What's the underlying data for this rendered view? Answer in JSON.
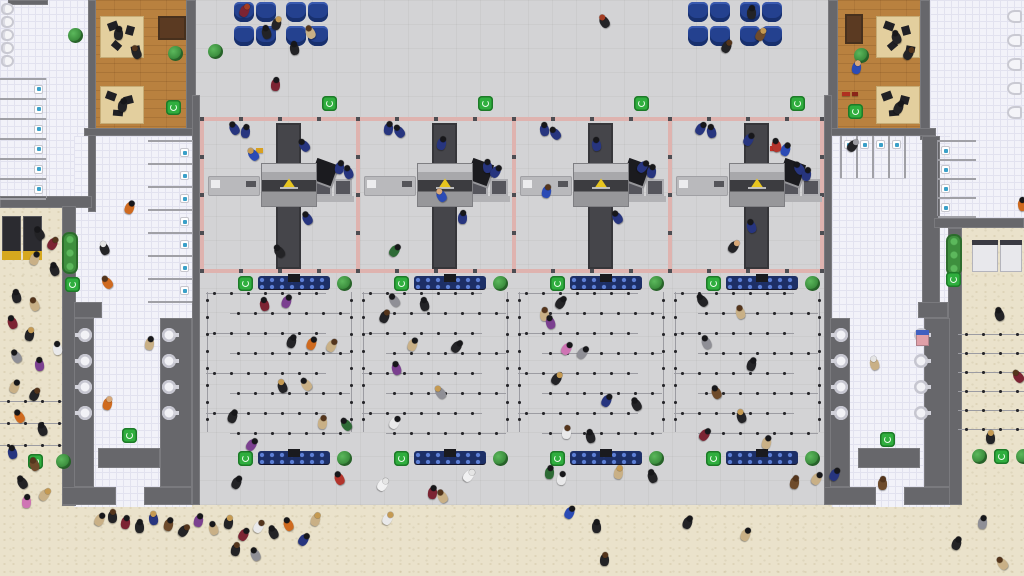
{
  "meta": {
    "app": "airport-simulation-game",
    "view": "overhead view of terminal security checkpoint zone, queues, restrooms, offices and landside entrances"
  },
  "palette": {
    "floor_gray": "#d3d3d5",
    "sand": "#eae2cb",
    "wall": "#67676b",
    "tile": "#f2f2f9",
    "wood": "#b9813f",
    "seat_blue": "#24418f",
    "security_border_pink": "#dfb3af",
    "bin_green": "#2fae3e",
    "plant_green": "#3e8f3e",
    "conveyor_dark": "#45454a",
    "machine_gray": "#a8a8ab",
    "xray_yellow": "#e8c51e",
    "bench_navy": "#1d2f66",
    "desk_tan": "#e3cf9e",
    "officer_navy": "#27357f"
  },
  "regions": [
    {
      "kind": "floor",
      "name": "terminal-hall-floor",
      "x": 192,
      "y": 0,
      "w": 640,
      "h": 505
    },
    {
      "kind": "tile",
      "name": "restroom-top-left-floor",
      "x": 0,
      "y": 0,
      "w": 92,
      "h": 204
    },
    {
      "kind": "wood",
      "name": "office-top-left-floor",
      "x": 88,
      "y": 0,
      "w": 108,
      "h": 132
    },
    {
      "kind": "tile",
      "name": "corridor-left-floor",
      "x": 74,
      "y": 136,
      "w": 118,
      "h": 371
    },
    {
      "kind": "tile",
      "name": "restroom-top-right-floor",
      "x": 930,
      "y": 0,
      "w": 94,
      "h": 222
    },
    {
      "kind": "wood",
      "name": "office-top-right-floor",
      "x": 828,
      "y": 0,
      "w": 102,
      "h": 132
    },
    {
      "kind": "tile",
      "name": "corridor-right-floor",
      "x": 832,
      "y": 136,
      "w": 118,
      "h": 371
    }
  ],
  "walls": [
    [
      8,
      0,
      40,
      5
    ],
    [
      88,
      0,
      8,
      212
    ],
    [
      186,
      0,
      10,
      132
    ],
    [
      84,
      128,
      112,
      8
    ],
    [
      0,
      196,
      92,
      12
    ],
    [
      62,
      206,
      14,
      300
    ],
    [
      74,
      302,
      28,
      16
    ],
    [
      192,
      95,
      8,
      410
    ],
    [
      74,
      318,
      20,
      169
    ],
    [
      160,
      318,
      32,
      169
    ],
    [
      98,
      448,
      62,
      20
    ],
    [
      62,
      487,
      54,
      18
    ],
    [
      144,
      487,
      48,
      18
    ],
    [
      920,
      0,
      10,
      140
    ],
    [
      828,
      0,
      10,
      132
    ],
    [
      824,
      128,
      112,
      8
    ],
    [
      922,
      136,
      18,
      182
    ],
    [
      934,
      218,
      90,
      10
    ],
    [
      948,
      228,
      14,
      277
    ],
    [
      918,
      302,
      30,
      16
    ],
    [
      824,
      95,
      8,
      410
    ],
    [
      830,
      318,
      20,
      169
    ],
    [
      924,
      318,
      26,
      169
    ],
    [
      858,
      448,
      62,
      20
    ],
    [
      824,
      487,
      52,
      18
    ],
    [
      904,
      487,
      46,
      18
    ]
  ],
  "security_border": {
    "v_xs": [
      200,
      356,
      512,
      668,
      820
    ],
    "y": 117,
    "h": 156,
    "h_spans": [
      [
        200,
        117,
        624
      ],
      [
        200,
        269,
        624
      ]
    ],
    "stud_ys": [
      117,
      155,
      193,
      231,
      269
    ],
    "stud_step_x": 39
  },
  "checkpoints": {
    "room_xs": [
      200,
      356,
      512,
      668
    ],
    "y": 117,
    "room_w": 156,
    "conveyor": {
      "dx": 76,
      "dy": 6,
      "w": 25,
      "h": 146
    },
    "machine": {
      "dx": 62,
      "dy": 47,
      "w": 54,
      "h": 42
    },
    "desk": {
      "dx": 8,
      "dy": 59,
      "w": 52,
      "h": 20
    },
    "monitor": {
      "dx": 113,
      "dy": 44,
      "w": 22,
      "h": 22
    },
    "trays": {
      "dx": 114,
      "dy": 62,
      "w": 18,
      "h": 17,
      "gap": 20
    },
    "shelf": {
      "dx": 110,
      "dy": 79,
      "w": 44,
      "h": 6
    }
  },
  "queue": {
    "block_xs": [
      204,
      360,
      516,
      672
    ],
    "top_y": 276,
    "bottom_y": 451,
    "bin_dx": 34,
    "bench_dx": 54,
    "bench_w": 72,
    "bench_h": 13,
    "plant_dx": 133,
    "lines_y0": 292,
    "lines_dy": 20,
    "lines_n": 8,
    "line_len": 120,
    "inset_even": 2,
    "inset_odd": 26,
    "v_edge_dx": [
      2,
      146
    ]
  },
  "sand_lines": {
    "left": {
      "x": 0,
      "w": 62,
      "ys": [
        400,
        422,
        444
      ]
    },
    "right": {
      "x": 958,
      "w": 66,
      "ys": [
        333,
        352,
        371,
        390,
        409,
        428
      ]
    }
  },
  "seats": {
    "size": 20,
    "groups": [
      {
        "x": 234,
        "y": 2,
        "cols": [
          0,
          22,
          52,
          74
        ],
        "rows": [
          0,
          24
        ]
      },
      {
        "x": 688,
        "y": 2,
        "cols": [
          0,
          22,
          52,
          74
        ],
        "rows": [
          0,
          24
        ]
      }
    ]
  },
  "urinals": {
    "x": 1,
    "y0": 3,
    "dy": 13,
    "n": 5
  },
  "toilets_wall": {
    "x": 1007,
    "y0": 10,
    "dy": 24,
    "n": 5
  },
  "stalls": [
    {
      "x": 0,
      "y0": 78,
      "w": 46,
      "dy": 20,
      "n": 6,
      "toilet": "right"
    },
    {
      "x": 148,
      "y0": 140,
      "w": 44,
      "dy": 23,
      "n": 7,
      "toilet": "right"
    },
    {
      "x": 938,
      "y0": 140,
      "w": 38,
      "dy": 19,
      "n": 4,
      "toilet": "left"
    }
  ],
  "stalls_v": {
    "x0": 840,
    "dx": 16,
    "n": 4,
    "y": 136,
    "h": 42
  },
  "fountains": [
    {
      "x": 78,
      "y0": 328,
      "dy": 26,
      "n": 4,
      "side": "fl"
    },
    {
      "x": 162,
      "y0": 328,
      "dy": 26,
      "n": 4,
      "side": "fr"
    },
    {
      "x": 834,
      "y0": 328,
      "dy": 26,
      "n": 4,
      "side": "fl"
    },
    {
      "x": 914,
      "y0": 328,
      "dy": 26,
      "n": 4,
      "side": "fr"
    }
  ],
  "vending": [
    {
      "x": 2,
      "y": 216,
      "w": 19,
      "h": 44,
      "s": "dark"
    },
    {
      "x": 23,
      "y": 216,
      "w": 19,
      "h": 44,
      "s": "dark"
    },
    {
      "x": 972,
      "y": 240,
      "w": 26,
      "h": 32,
      "s": "light"
    },
    {
      "x": 1000,
      "y": 240,
      "w": 22,
      "h": 32,
      "s": "light"
    },
    {
      "x": 916,
      "y": 330,
      "w": 13,
      "h": 16,
      "s": "pink"
    }
  ],
  "planters": [
    [
      62,
      232,
      16,
      42
    ],
    [
      946,
      234,
      16,
      42
    ]
  ],
  "plants": [
    [
      168,
      46
    ],
    [
      854,
      48
    ],
    [
      68,
      28
    ],
    [
      208,
      44
    ],
    [
      56,
      454
    ],
    [
      972,
      449
    ],
    [
      1016,
      449
    ]
  ],
  "bins": [
    [
      322,
      96
    ],
    [
      478,
      96
    ],
    [
      634,
      96
    ],
    [
      790,
      96
    ],
    [
      166,
      100
    ],
    [
      848,
      104
    ],
    [
      122,
      428
    ],
    [
      880,
      432
    ],
    [
      28,
      454
    ],
    [
      65,
      277
    ],
    [
      946,
      272
    ],
    [
      994,
      449
    ]
  ],
  "office_benches": [
    [
      158,
      16,
      28,
      24
    ],
    [
      845,
      14,
      18,
      30
    ]
  ],
  "office_desks": [
    [
      100,
      16,
      44,
      42
    ],
    [
      100,
      86,
      44,
      38
    ],
    [
      876,
      16,
      44,
      42
    ],
    [
      876,
      86,
      44,
      38
    ]
  ],
  "office_items": [
    [
      108,
      22,
      10,
      8,
      -20
    ],
    [
      126,
      26,
      8,
      9,
      15
    ],
    [
      112,
      42,
      9,
      7,
      40
    ],
    [
      131,
      46,
      9,
      6,
      -10
    ],
    [
      106,
      92,
      10,
      8,
      20
    ],
    [
      124,
      96,
      9,
      8,
      -15
    ],
    [
      113,
      110,
      10,
      6,
      5
    ],
    [
      884,
      22,
      10,
      8,
      20
    ],
    [
      902,
      26,
      8,
      9,
      -15
    ],
    [
      888,
      42,
      9,
      7,
      -40
    ],
    [
      906,
      46,
      9,
      6,
      10
    ],
    [
      882,
      92,
      10,
      8,
      -20
    ],
    [
      900,
      96,
      9,
      8,
      15
    ],
    [
      889,
      110,
      10,
      6,
      -5
    ]
  ],
  "props": [
    [
      256,
      148,
      "#d8a020",
      7,
      5
    ],
    [
      770,
      146,
      "#c03028",
      7,
      5
    ],
    [
      842,
      92,
      "#b03020",
      8,
      4
    ],
    [
      852,
      92,
      "#8a2418",
      6,
      4
    ]
  ],
  "officers": [
    [
      230,
      123
    ],
    [
      241,
      126
    ],
    [
      300,
      140
    ],
    [
      335,
      162
    ],
    [
      344,
      167
    ],
    [
      303,
      213
    ],
    [
      384,
      123
    ],
    [
      395,
      126
    ],
    [
      437,
      138
    ],
    [
      483,
      161
    ],
    [
      491,
      166
    ],
    [
      458,
      212
    ],
    [
      540,
      124
    ],
    [
      551,
      128
    ],
    [
      592,
      139
    ],
    [
      638,
      161
    ],
    [
      647,
      166
    ],
    [
      613,
      212
    ],
    [
      696,
      123
    ],
    [
      707,
      126
    ],
    [
      744,
      134
    ],
    [
      795,
      163
    ],
    [
      802,
      169
    ],
    [
      747,
      221
    ]
  ],
  "people": [
    [
      240,
      5,
      "#7c2433",
      "#a33c22"
    ],
    [
      262,
      27,
      "#232326",
      "#17171a"
    ],
    [
      306,
      27,
      "#c9b086",
      "#54351c"
    ],
    [
      272,
      18,
      "#232326",
      "#c59a52"
    ],
    [
      290,
      43,
      "#232326",
      "#17171a"
    ],
    [
      271,
      79,
      "#7c2433",
      "#17171a"
    ],
    [
      600,
      16,
      "#232326",
      "#a33c22"
    ],
    [
      747,
      7,
      "#232326",
      "#17171a"
    ],
    [
      756,
      29,
      "#6e4b2b",
      "#c59a52"
    ],
    [
      722,
      41,
      "#232326",
      "#54351c"
    ],
    [
      114,
      28,
      "#232326",
      "#17171a"
    ],
    [
      132,
      47,
      "#232326",
      "#54351c"
    ],
    [
      118,
      100,
      "#232326",
      "#17171a"
    ],
    [
      892,
      32,
      "#232326",
      "#17171a"
    ],
    [
      904,
      48,
      "#232326",
      "#54351c"
    ],
    [
      852,
      62,
      "#2b4bb5",
      "#d8a878"
    ],
    [
      894,
      102,
      "#232326",
      "#17171a"
    ],
    [
      125,
      202,
      "#cf6a1f",
      "#17171a"
    ],
    [
      100,
      243,
      "#232326",
      "#e5e5e5"
    ],
    [
      103,
      277,
      "#cf6a1f",
      "#54351c"
    ],
    [
      145,
      338,
      "#c9b086",
      "#17171a"
    ],
    [
      103,
      398,
      "#cf6a1f",
      "#d8a878"
    ],
    [
      848,
      140,
      "#232326",
      "#9a9aa0"
    ],
    [
      870,
      358,
      "#c9b086",
      "#e5e5e5"
    ],
    [
      878,
      478,
      "#6e4b2b",
      "#54351c"
    ],
    [
      249,
      149,
      "#2b4bb5",
      "#c59a52"
    ],
    [
      275,
      246,
      "#232326",
      "#17171a"
    ],
    [
      390,
      245,
      "#2e6b36",
      "#17171a"
    ],
    [
      437,
      190,
      "#2b4bb5",
      "#d8a878"
    ],
    [
      542,
      186,
      "#2b4bb5",
      "#54351c"
    ],
    [
      772,
      140,
      "#b3342c",
      "#17171a"
    ],
    [
      781,
      144,
      "#2b4bb5",
      "#17171a"
    ],
    [
      729,
      241,
      "#232326",
      "#d8a878"
    ],
    [
      282,
      296,
      "#7b4090",
      "#17171a"
    ],
    [
      260,
      299,
      "#7c2433",
      "#17171a"
    ],
    [
      287,
      336,
      "#232326",
      "#17171a"
    ],
    [
      307,
      338,
      "#cf6a1f",
      "#17171a"
    ],
    [
      327,
      340,
      "#c9b086",
      "#54351c"
    ],
    [
      302,
      379,
      "#c9b086",
      "#17171a"
    ],
    [
      278,
      381,
      "#232326",
      "#c59a52"
    ],
    [
      228,
      411,
      "#232326",
      "#17171a"
    ],
    [
      318,
      417,
      "#c9b086",
      "#54351c"
    ],
    [
      342,
      419,
      "#2e6b36",
      "#17171a"
    ],
    [
      247,
      439,
      "#7b4090",
      "#17171a"
    ],
    [
      390,
      295,
      "#8f8f96",
      "#17171a"
    ],
    [
      420,
      299,
      "#232326",
      "#17171a"
    ],
    [
      380,
      311,
      "#232326",
      "#54351c"
    ],
    [
      408,
      339,
      "#c9b086",
      "#17171a"
    ],
    [
      452,
      341,
      "#232326",
      "#17171a"
    ],
    [
      392,
      363,
      "#7b4090",
      "#17171a"
    ],
    [
      436,
      387,
      "#8f8f96",
      "#c59a52"
    ],
    [
      390,
      417,
      "#e9e9ea",
      "#17171a"
    ],
    [
      556,
      297,
      "#232326",
      "#17171a"
    ],
    [
      540,
      309,
      "#c9b086",
      "#54351c"
    ],
    [
      546,
      317,
      "#7b4090",
      "#17171a"
    ],
    [
      562,
      343,
      "#cf74b4",
      "#17171a"
    ],
    [
      578,
      347,
      "#8f8f96",
      "#17171a"
    ],
    [
      552,
      373,
      "#232326",
      "#c59a52"
    ],
    [
      602,
      395,
      "#27357f",
      "#17171a"
    ],
    [
      632,
      399,
      "#232326",
      "#17171a"
    ],
    [
      562,
      427,
      "#e9e9ea",
      "#54351c"
    ],
    [
      586,
      431,
      "#232326",
      "#17171a"
    ],
    [
      698,
      295,
      "#232326",
      "#17171a"
    ],
    [
      736,
      307,
      "#c9b086",
      "#54351c"
    ],
    [
      702,
      337,
      "#8f8f96",
      "#17171a"
    ],
    [
      747,
      359,
      "#232326",
      "#17171a"
    ],
    [
      712,
      387,
      "#6e4b2b",
      "#17171a"
    ],
    [
      737,
      411,
      "#232326",
      "#c59a52"
    ],
    [
      762,
      437,
      "#c9b086",
      "#17171a"
    ],
    [
      700,
      429,
      "#7c2433",
      "#17171a"
    ],
    [
      232,
      477,
      "#232326",
      "#17171a"
    ],
    [
      335,
      473,
      "#b3342c",
      "#17171a"
    ],
    [
      378,
      479,
      "#ffffffb0",
      "#e5e5e5"
    ],
    [
      464,
      470,
      "#ffffffb0",
      "#e5e5e5"
    ],
    [
      428,
      487,
      "#7c2433",
      "#17171a"
    ],
    [
      438,
      491,
      "#c9b086",
      "#54351c"
    ],
    [
      545,
      467,
      "#2e6b36",
      "#17171a"
    ],
    [
      557,
      473,
      "#e9e9ea",
      "#17171a"
    ],
    [
      614,
      467,
      "#c9b086",
      "#c59a52"
    ],
    [
      648,
      471,
      "#232326",
      "#17171a"
    ],
    [
      790,
      477,
      "#6e4b2b",
      "#54351c"
    ],
    [
      812,
      473,
      "#c9b086",
      "#17171a"
    ],
    [
      830,
      469,
      "#27357f",
      "#17171a"
    ],
    [
      95,
      514,
      "#c9b086",
      "#17171a"
    ],
    [
      108,
      511,
      "#232326",
      "#54351c"
    ],
    [
      121,
      517,
      "#7c2433",
      "#17171a"
    ],
    [
      135,
      521,
      "#232326",
      "#17171a"
    ],
    [
      149,
      513,
      "#27357f",
      "#c59a52"
    ],
    [
      164,
      519,
      "#6e4b2b",
      "#17171a"
    ],
    [
      179,
      525,
      "#232326",
      "#54351c"
    ],
    [
      194,
      515,
      "#7b4090",
      "#17171a"
    ],
    [
      209,
      523,
      "#c9b086",
      "#17171a"
    ],
    [
      224,
      517,
      "#232326",
      "#c59a52"
    ],
    [
      239,
      529,
      "#7c2433",
      "#17171a"
    ],
    [
      254,
      521,
      "#e9e9ea",
      "#54351c"
    ],
    [
      269,
      527,
      "#232326",
      "#17171a"
    ],
    [
      284,
      519,
      "#cf6a1f",
      "#17171a"
    ],
    [
      231,
      544,
      "#232326",
      "#54351c"
    ],
    [
      251,
      549,
      "#8f8f96",
      "#17171a"
    ],
    [
      299,
      534,
      "#27357f",
      "#17171a"
    ],
    [
      311,
      514,
      "#c9b086",
      "#c59a52"
    ],
    [
      383,
      513,
      "#e9e9ea",
      "#c59a52"
    ],
    [
      565,
      507,
      "#2b4bb5",
      "#17171a"
    ],
    [
      592,
      521,
      "#232326",
      "#17171a"
    ],
    [
      600,
      554,
      "#232326",
      "#54351c"
    ],
    [
      683,
      517,
      "#232326",
      "#17171a"
    ],
    [
      741,
      529,
      "#c9b086",
      "#17171a"
    ],
    [
      952,
      538,
      "#232326",
      "#17171a"
    ],
    [
      978,
      517,
      "#8f8f96",
      "#17171a"
    ],
    [
      998,
      558,
      "#c9b086",
      "#54351c"
    ],
    [
      12,
      291,
      "#232326",
      "#17171a"
    ],
    [
      30,
      299,
      "#c9b086",
      "#54351c"
    ],
    [
      8,
      317,
      "#7c2433",
      "#17171a"
    ],
    [
      25,
      329,
      "#232326",
      "#c59a52"
    ],
    [
      12,
      351,
      "#8f8f96",
      "#17171a"
    ],
    [
      35,
      359,
      "#7b4090",
      "#17171a"
    ],
    [
      10,
      381,
      "#c9b086",
      "#17171a"
    ],
    [
      30,
      389,
      "#232326",
      "#54351c"
    ],
    [
      15,
      411,
      "#cf6a1f",
      "#17171a"
    ],
    [
      38,
      424,
      "#232326",
      "#17171a"
    ],
    [
      8,
      447,
      "#27357f",
      "#17171a"
    ],
    [
      30,
      459,
      "#6e4b2b",
      "#54351c"
    ],
    [
      18,
      477,
      "#232326",
      "#17171a"
    ],
    [
      40,
      489,
      "#c9b086",
      "#c59a52"
    ],
    [
      53,
      343,
      "#e9e9ea",
      "#17171a"
    ],
    [
      35,
      228,
      "#232326",
      "#17171a"
    ],
    [
      48,
      238,
      "#7c2433",
      "#54351c"
    ],
    [
      30,
      253,
      "#c9b086",
      "#17171a"
    ],
    [
      50,
      264,
      "#232326",
      "#17171a"
    ],
    [
      22,
      496,
      "#cf74b4",
      "#17171a"
    ],
    [
      995,
      309,
      "#232326",
      "#17171a"
    ],
    [
      1018,
      199,
      "#cf6a1f",
      "#17171a"
    ],
    [
      1014,
      371,
      "#7c2433",
      "#54351c"
    ],
    [
      986,
      432,
      "#232326",
      "#c59a52"
    ]
  ]
}
